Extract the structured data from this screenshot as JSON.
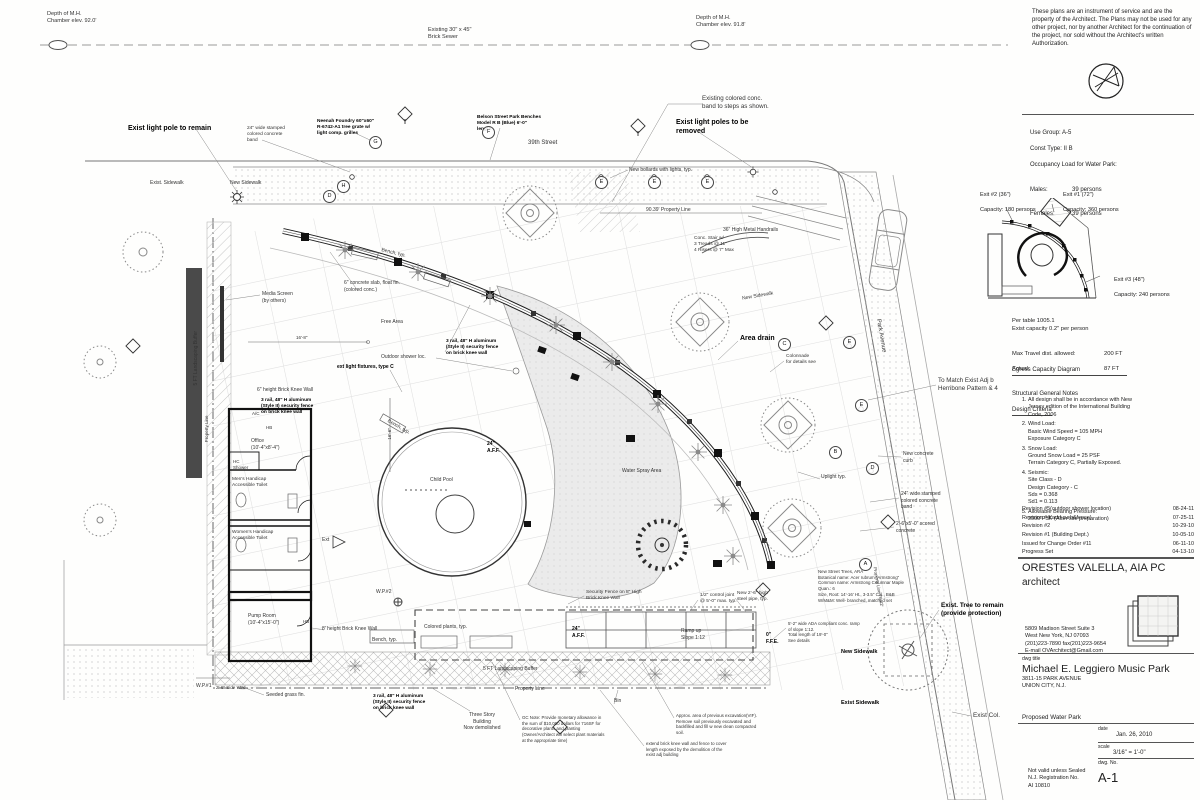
{
  "disclaimer": "These plans are an instrument of service and are the property of the Architect. The Plans may not be used for any other project, nor by another Architect for the continuation of the project, nor sold without the Architect's written Authorization.",
  "code_info": {
    "use_group": "Use Group: A-5",
    "const_type": "Const Type: II B",
    "occupancy_heading": "Occupancy Load for Water Park:",
    "males_label": "Males:",
    "males_value": "39 persons",
    "females_label": "Females:",
    "females_value": "39 persons"
  },
  "egress": {
    "exit2_label": "Exit #2 (36\")",
    "exit2_capacity": "Capacity: 180 persons",
    "exit1_label": "Exit #1 (72\")",
    "exit1_capacity": "Capacity: 360 persons",
    "exit3_label": "Exit #3 (48\")",
    "exit3_capacity": "Capacity: 240 persons",
    "per_table": "Per table 1005.1\nExist capacity 0.2\" per person",
    "max_travel_label": "Max Travel dist. allowed:",
    "max_travel_value": "200 FT",
    "actual_label": "Actual:",
    "actual_value": "87 FT",
    "title": "Egress Capacity Diagram"
  },
  "notes": {
    "title": "Structural General Notes",
    "subtitle": "Design Criteria",
    "items": [
      "All design shall be in accordance with New\nJersey edition of the International Building\nCode, 2006",
      "Wind Load:\nBasic Wind Speed = 105 MPH\nExposure Category C",
      "Snow Load:\nGround Snow Load = 25 PSF\nTerrain Category C, Partially Exposed.",
      "Seismic:\nSite Class - D\nDesign Category - C\nSds = 0.368\nSd1 = 0.113",
      "Allowable Bearing Pressure:\n2000 PSF (After site preparation)"
    ]
  },
  "revisions": [
    {
      "label": "Revision #5(outdoor shower location)",
      "date": "08-24-11"
    },
    {
      "label": "Revision #4(add curb&fence)",
      "date": "07-25-11"
    },
    {
      "label": "Revision #2",
      "date": "10-29-10"
    },
    {
      "label": "Revision #1 (Building Dept.)",
      "date": "10-05-10"
    },
    {
      "label": "Issued for Change Order #11",
      "date": "06-11-10"
    },
    {
      "label": "Progress Set",
      "date": "04-13-10"
    }
  ],
  "architect": {
    "name": "ORESTES VALELLA, AIA PC",
    "role": "architect",
    "address": "5809 Madison Street Suite 3\nWest New York, NJ 07093\n(201)223-7890 fax(201)223-9654\nE-mail OVArchitect@Gmail.com"
  },
  "titleblock": {
    "dwg_title_label": "dwg title",
    "project_name": "Michael E. Leggiero Music Park",
    "project_address": "3811-15  PARK AVENUE\nUNION CITY, N.J.",
    "sheet_title": "Proposed Water Park",
    "date_label": "date",
    "date_value": "Jan. 26, 2010",
    "scale_label": "scale",
    "scale_value": "3/16\" = 1'-0\"",
    "dwg_no_label": "dwg. No.",
    "dwg_no_value": "A-1",
    "seal_note": "Not valid unless Sealed\nN.J. Registration No.\nAI 10810"
  },
  "plan": {
    "labels": [
      {
        "n": "depth-mh-left",
        "t": "Depth of M.H.\nChamber elev. 92.0'",
        "x": 47,
        "y": 11,
        "s": 5.6
      },
      {
        "n": "brick-sewer-label",
        "t": "Existing 30\" x 45\"\nBrick Sewer",
        "x": 428,
        "y": 27,
        "s": 5.6
      },
      {
        "n": "depth-mh-right",
        "t": "Depth of M.H.\nChamber elev. 91.8'",
        "x": 696,
        "y": 15,
        "s": 5.6
      },
      {
        "n": "exist-light-pole-remain",
        "t": "Exist light pole to remain",
        "x": 128,
        "y": 124,
        "s": 7,
        "b": 1
      },
      {
        "n": "stamped-band-top",
        "t": "24\" wide stamped\ncolored concrete\nband",
        "x": 247,
        "y": 126,
        "s": 4.8
      },
      {
        "n": "neenah-foundry-note",
        "t": "Neenah Foundry 60\"x60\"\nR-6742-A1 tree grate w/\nlight comp. grilles",
        "x": 317,
        "y": 119,
        "s": 4.8,
        "b": 1
      },
      {
        "n": "belson-benches-note",
        "t": "Belson Street Park Benches\nModel R B (Blue) 6'-0\"\nlength",
        "x": 477,
        "y": 115,
        "s": 4.8,
        "b": 1
      },
      {
        "n": "street-39-label",
        "t": "39th Street",
        "x": 528,
        "y": 140,
        "s": 6
      },
      {
        "n": "exist-light-poles-removed",
        "t": "Exist light poles to be\nremoved",
        "x": 676,
        "y": 118,
        "s": 7,
        "b": 1
      },
      {
        "n": "colored-conc-band-steps",
        "t": "Existing colored  conc.\nband to steps as shown.",
        "x": 702,
        "y": 95,
        "s": 6.2
      },
      {
        "n": "new-bollards-note",
        "t": "New bollards with lights, typ.",
        "x": 629,
        "y": 167,
        "s": 5
      },
      {
        "n": "exist-sidewalk-top",
        "t": "Exist. Sidewalk",
        "x": 150,
        "y": 180,
        "s": 5
      },
      {
        "n": "new-sidewalk-top",
        "t": "New  Sidewalk",
        "x": 230,
        "y": 180,
        "s": 5
      },
      {
        "n": "property-line-top",
        "t": "90.39'  Property Line",
        "x": 646,
        "y": 207,
        "s": 5
      },
      {
        "n": "metal-handrails-note",
        "t": "36\" High Metal Handrails",
        "x": 723,
        "y": 227,
        "s": 5
      },
      {
        "n": "conc-stair-note",
        "t": "Conc. Stair w/\n3 Treads @ 11\"\n4 Risers @ 7\" Max",
        "x": 694,
        "y": 236,
        "s": 4.8
      },
      {
        "n": "bench-typ-arc",
        "t": "Bench, typ.",
        "x": 381,
        "y": 250,
        "s": 5,
        "r": 14
      },
      {
        "n": "media-screen-note",
        "t": "Media Screen\n(by others)",
        "x": 262,
        "y": 291,
        "s": 5
      },
      {
        "n": "landscape-buffer-left",
        "t": "5 FT Landscaping Buffer",
        "x": 151,
        "y": 355,
        "s": 5,
        "r": -90,
        "w": 90
      },
      {
        "n": "conc-slab-note",
        "t": "6\" concrete slab, float fin.\n(colored conc.)",
        "x": 344,
        "y": 280,
        "s": 5
      },
      {
        "n": "free-area-label",
        "t": "Free Area",
        "x": 381,
        "y": 319,
        "s": 5
      },
      {
        "n": "new-sidewalk-right",
        "t": "New Sidewalk",
        "x": 742,
        "y": 293,
        "s": 5,
        "r": -10
      },
      {
        "n": "area-drain-label",
        "t": "Area drain",
        "x": 740,
        "y": 334,
        "s": 7,
        "b": 1
      },
      {
        "n": "park-avenue-label",
        "t": "Park Avenue",
        "x": 857,
        "y": 332,
        "s": 6,
        "r": 80,
        "w": 46
      },
      {
        "n": "security-fence-mid",
        "t": "3 rail, 48\" H aluminum\n(Style II) security fence\non brick knee wall",
        "x": 446,
        "y": 339,
        "s": 4.8,
        "b": 1
      },
      {
        "n": "outdoor-shower-note",
        "t": "Outdoor shower loc.",
        "x": 381,
        "y": 354,
        "s": 5
      },
      {
        "n": "wall-light-fixtures-note",
        "t": "ext light fixtures, type C",
        "x": 337,
        "y": 364,
        "s": 5,
        "b": 1
      },
      {
        "n": "colonnade-note",
        "t": "Colonnade\nfor details see",
        "x": 786,
        "y": 354,
        "s": 4.8
      },
      {
        "n": "to-match-note",
        "t": "To Match Exist Adj b\nHerribone Pattern & 4",
        "x": 938,
        "y": 377,
        "s": 6.2
      },
      {
        "n": "knee-wall-6in",
        "t": "6\" height Brick Knee Wall",
        "x": 257,
        "y": 387,
        "s": 5
      },
      {
        "n": "security-fence-office",
        "t": "3 rail, 48\" H aluminum\n(Style II) security fence\non brick knee wall",
        "x": 261,
        "y": 398,
        "s": 4.8,
        "b": 1
      },
      {
        "n": "ac-label",
        "t": "A/C",
        "x": 252,
        "y": 411,
        "s": 4.5
      },
      {
        "n": "hb-office",
        "t": "HB",
        "x": 266,
        "y": 425,
        "s": 4.5
      },
      {
        "n": "office-label",
        "t": "Office\n(10'-4\"x8'-4\")",
        "x": 251,
        "y": 438,
        "s": 5
      },
      {
        "n": "hc-shower-label",
        "t": "HC\nShower",
        "x": 233,
        "y": 459,
        "s": 4.5
      },
      {
        "n": "mens-toilet-label",
        "t": "Men's Handicap\nAccessible Toilet",
        "x": 232,
        "y": 477,
        "s": 4.8
      },
      {
        "n": "womens-toilet-label",
        "t": "Women's Handicap\nAccessible Toilet",
        "x": 232,
        "y": 530,
        "s": 4.8
      },
      {
        "n": "child-pool-label",
        "t": "Child Pool",
        "x": 430,
        "y": 477,
        "s": 5
      },
      {
        "n": "aff-pool-label",
        "t": "24\"\nA.F.F.",
        "x": 487,
        "y": 441,
        "s": 5,
        "b": 1
      },
      {
        "n": "water-spray-label",
        "t": "Water Spray Area",
        "x": 622,
        "y": 468,
        "s": 5
      },
      {
        "n": "new-curb-note",
        "t": "New concrete\ncurb",
        "x": 903,
        "y": 451,
        "s": 5
      },
      {
        "n": "stamped-band-right",
        "t": "24\" wide stamped\ncolored concrete\nband",
        "x": 901,
        "y": 491,
        "s": 5
      },
      {
        "n": "scored-conc-note",
        "t": "2'-6\"x5'-0\" scored\nconcrete",
        "x": 896,
        "y": 521,
        "s": 5
      },
      {
        "n": "uplight-label",
        "t": "Uplight typ.",
        "x": 821,
        "y": 474,
        "s": 5
      },
      {
        "n": "ext-label",
        "t": "Ext",
        "x": 322,
        "y": 537,
        "s": 5
      },
      {
        "n": "wp2-label",
        "t": "W.P.#2",
        "x": 376,
        "y": 589,
        "s": 5
      },
      {
        "n": "security-fence-8-high",
        "t": "Security Fence on 8\" High\nBrick Knee Wall",
        "x": 586,
        "y": 590,
        "s": 4.8
      },
      {
        "n": "new-street-trees-note",
        "t": "New Street Trees, ARA\nBotanical name: Acer rubrum \"Armstrong\"\nCommon name: Armstrong Columnar Maple\nQuan.: 6\nSize, Root: 14'-16' Ht., 3-3.5\" Cal., B&B\nW/M&M: Well- branched, matched set",
        "x": 818,
        "y": 569,
        "s": 4.4
      },
      {
        "n": "exist-tree-remain",
        "t": "Exist. Tree to remain\n(provide protection)",
        "x": 941,
        "y": 602,
        "s": 6.4,
        "b": 1
      },
      {
        "n": "control-joint-note",
        "t": "1/2\" control joint\n@ 5'-0\" max. typ.",
        "x": 700,
        "y": 593,
        "s": 4.8
      },
      {
        "n": "steel-pipe-note",
        "t": "New 2'-6\" high\nsteel pipe, typ.",
        "x": 737,
        "y": 591,
        "s": 4.8
      },
      {
        "n": "ramp-up-label",
        "t": "Ramp up\nSlope 1:12",
        "x": 681,
        "y": 628,
        "s": 5
      },
      {
        "n": "aff-ramp-label",
        "t": "24\"\nA.F.F.",
        "x": 572,
        "y": 626,
        "s": 5,
        "b": 1
      },
      {
        "n": "ffe-label",
        "t": "0\"\nF.F.E.",
        "x": 766,
        "y": 632,
        "s": 5,
        "b": 1
      },
      {
        "n": "ada-ramp-note",
        "t": "5'-2\" wide ADA compliant conc. ramp\nof slope 1:12.\nTotal length of 19'-0\"\nSee details",
        "x": 788,
        "y": 621,
        "s": 4.4
      },
      {
        "n": "new-sidewalk-bottom",
        "t": "New  Sidewalk",
        "x": 841,
        "y": 649,
        "s": 5.5,
        "b": 1
      },
      {
        "n": "colored-plants-note",
        "t": "Colored plants, typ.",
        "x": 424,
        "y": 624,
        "s": 5
      },
      {
        "n": "pump-room-label",
        "t": "Pump Room\n(10'-4\"x15'-0\")",
        "x": 248,
        "y": 613,
        "s": 5
      },
      {
        "n": "hb-pump",
        "t": "HB",
        "x": 303,
        "y": 619,
        "s": 4.5
      },
      {
        "n": "knee-wall-8ft",
        "t": "8' height Brick Knee Wall",
        "x": 322,
        "y": 626,
        "s": 5
      },
      {
        "n": "bench-typ-bottom",
        "t": "Bench, typ.",
        "x": 372,
        "y": 637,
        "s": 5
      },
      {
        "n": "wp1-label",
        "t": "W.P.#1",
        "x": 196,
        "y": 683,
        "s": 5
      },
      {
        "n": "side-yard-dim",
        "t": "2'-6\" Side Yard",
        "x": 216,
        "y": 685,
        "s": 4.5
      },
      {
        "n": "seeded-grass-note",
        "t": "Seeded grass fin.",
        "x": 266,
        "y": 692,
        "s": 5
      },
      {
        "n": "security-fence-bottom",
        "t": "3 rail, 48\" H aluminum\n(Style II) security fence\non brick knee wall",
        "x": 373,
        "y": 694,
        "s": 4.8,
        "b": 1
      },
      {
        "n": "landscape-buffer-bottom",
        "t": "5 FT Landscaping Buffer",
        "x": 483,
        "y": 666,
        "s": 5
      },
      {
        "n": "property-line-bottom",
        "t": "Property Line",
        "x": 515,
        "y": 686,
        "s": 5
      },
      {
        "n": "three-story-note",
        "t": "Three Story\nBuilding\nNow demolished",
        "x": 461,
        "y": 712,
        "s": 5,
        "w": 42
      },
      {
        "n": "gc-note",
        "t": "GC Note: Provide monetary allowance in\nthe sum of $10,000 dollars for 716SF for\ndecorative plants and planting\n(Owner/Architect will select  plant materials\nat the appropriate time)",
        "x": 522,
        "y": 715,
        "s": 4.4
      },
      {
        "n": "bin-label",
        "t": "Bin",
        "x": 614,
        "y": 698,
        "s": 5
      },
      {
        "n": "excavation-note",
        "t": "Approx. area of previous excavation(VIF).\nRemove soil previously excavated and\nbackfilled and fill w new clean compacted\nsoil.",
        "x": 676,
        "y": 713,
        "s": 4.4
      },
      {
        "n": "extend-wall-note",
        "t": "extend brick knee wall and fence to cover\nlength exposed by the demolition of the\nexist adj building",
        "x": 646,
        "y": 741,
        "s": 4.4
      },
      {
        "n": "exist-sidewalk-bottom",
        "t": "Exist Sidewalk",
        "x": 841,
        "y": 700,
        "s": 5.5,
        "b": 1
      },
      {
        "n": "exist-col-label",
        "t": "Exist Col.",
        "x": 973,
        "y": 712,
        "s": 6.4
      },
      {
        "n": "dim-16-8",
        "t": "16'-8\"",
        "x": 296,
        "y": 335,
        "s": 4.5
      },
      {
        "n": "dim-16-6",
        "t": "16'-6\"",
        "x": 375,
        "y": 431,
        "s": 4.5,
        "r": -90,
        "w": 30
      },
      {
        "n": "property-line-left",
        "t": "Property Line",
        "x": 177,
        "y": 426,
        "s": 4.5,
        "r": -90,
        "w": 60
      },
      {
        "n": "property-line-park",
        "t": "Property Line  76.42'",
        "x": 838,
        "y": 584,
        "s": 4.5,
        "r": 80,
        "w": 80
      },
      {
        "n": "bench-typ-arc2",
        "t": "Bench, typ.",
        "x": 386,
        "y": 424,
        "s": 5,
        "r": 30
      }
    ],
    "markers": [
      {
        "l": "G",
        "x": 369,
        "y": 136
      },
      {
        "l": "F",
        "x": 482,
        "y": 126
      },
      {
        "l": "H",
        "x": 337,
        "y": 180
      },
      {
        "l": "D",
        "x": 323,
        "y": 190
      },
      {
        "l": "E",
        "x": 595,
        "y": 176
      },
      {
        "l": "E",
        "x": 648,
        "y": 176
      },
      {
        "l": "E",
        "x": 701,
        "y": 176
      },
      {
        "l": "E",
        "x": 843,
        "y": 336
      },
      {
        "l": "E",
        "x": 855,
        "y": 399
      },
      {
        "l": "D",
        "x": 866,
        "y": 462
      },
      {
        "l": "C",
        "x": 778,
        "y": 338
      },
      {
        "l": "B",
        "x": 829,
        "y": 446
      },
      {
        "l": "A",
        "x": 859,
        "y": 558
      }
    ]
  }
}
